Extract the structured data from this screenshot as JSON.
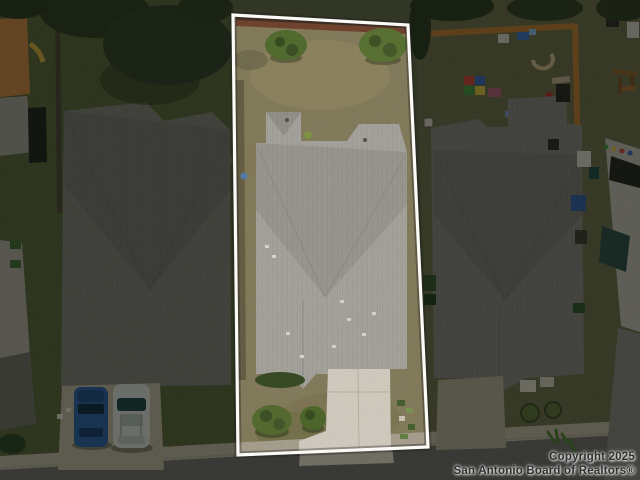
{
  "meta": {
    "type": "aerial-real-estate-photo",
    "alt": "Top-down drone photo of three suburban houses with gray shingle roofs; the center lot is highlighted with a white property outline while surrounding lots are dimmed; street and sidewalk at bottom; MLS watermark lower right",
    "width": 640,
    "height": 480
  },
  "watermark": {
    "line1": "Copyright 2025",
    "line2": "San Antonio Board of Realtors®",
    "text_color": "#2f2f2f"
  },
  "highlight": {
    "border_color": "#fbfaf6",
    "polygon_points": "233,15 408,25 428,447 238,455",
    "dim_path": "M0,0H640V480H0Z M233,15L408,25L428,447L238,455Z",
    "dim_color": "rgba(8,10,6,0.45)"
  },
  "palette": {
    "grass_base": "#5d6344",
    "grass_left": "#566239",
    "grass_right": "#676a48",
    "grass_center_dry": "#8f8764",
    "roof_center": "#b5b2ab",
    "roof_left": "#7e7c75",
    "roof_right": "#81807a",
    "street": "#6b6965",
    "sidewalk": "#b5ad9a",
    "driveway_center": "#e3ddd0",
    "driveway_left": "#b3ac97",
    "driveway_right": "#aaa38e",
    "fence_orange": "#b3762f",
    "fence_brick": "#7a4a33",
    "tree_dark": "#31402a",
    "car_blue": "#2a5f9e",
    "car_white": "#cfd2cc"
  }
}
